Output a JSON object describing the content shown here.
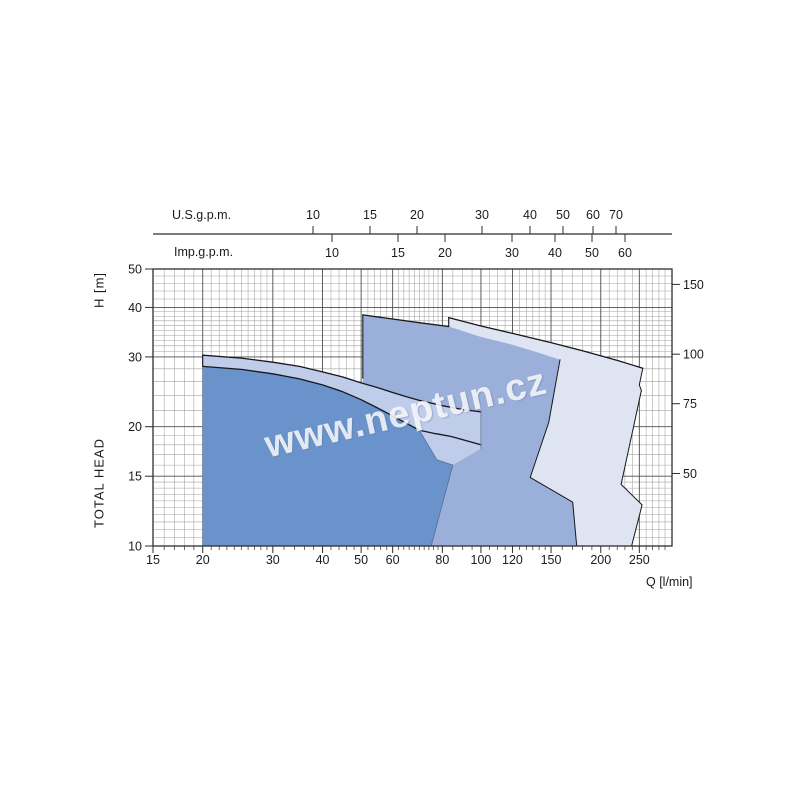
{
  "watermark": {
    "text": "www.neptun.cz",
    "color": "rgba(255,255,255,0.82)"
  },
  "titles": {
    "us_scale": "U.S.g.p.m.",
    "imp_scale": "Imp.g.p.m.",
    "y_left_unit": "H [m]",
    "y_left_name": "TOTAL HEAD",
    "x_bottom": "Q [l/min]"
  },
  "chart_data": {
    "type": "area",
    "title": "Pump family H-Q envelope chart",
    "x_axis": {
      "label": "Q [l/min]",
      "scale": "log",
      "min": 15,
      "max": 302,
      "major_ticks": [
        15,
        20,
        30,
        40,
        50,
        60,
        80,
        100,
        120,
        150,
        200,
        250
      ]
    },
    "y_axis": {
      "label": "H [m] TOTAL HEAD",
      "scale": "log",
      "min": 10,
      "max": 50,
      "major_ticks": [
        50,
        40,
        30,
        20,
        15,
        10
      ]
    },
    "y_axis_right": {
      "unit": "ft",
      "ticks": [
        150,
        100,
        75,
        50
      ],
      "m_per_ft": 0.3048
    },
    "us_gpm_scale": {
      "ticks": [
        [
          10,
          313
        ],
        [
          15,
          370
        ],
        [
          20,
          417
        ],
        [
          30,
          482
        ],
        [
          40,
          530
        ],
        [
          50,
          563
        ],
        [
          60,
          593
        ],
        [
          70,
          616
        ]
      ]
    },
    "imp_gpm_scale": {
      "ticks": [
        [
          10,
          332
        ],
        [
          15,
          398
        ],
        [
          20,
          445
        ],
        [
          30,
          512
        ],
        [
          40,
          555
        ],
        [
          50,
          592
        ],
        [
          60,
          625
        ]
      ]
    },
    "grid": {
      "v_major": [
        20,
        30,
        40,
        50,
        60,
        80,
        100,
        120,
        150,
        200,
        250
      ],
      "v_minor": [
        16,
        17,
        18,
        19,
        21,
        22,
        23,
        24,
        25,
        26,
        27,
        28,
        29,
        32,
        34,
        36,
        38,
        42,
        44,
        46,
        48,
        52,
        54,
        56,
        58,
        62,
        64,
        66,
        68,
        70,
        72,
        74,
        76,
        78,
        85,
        90,
        95,
        105,
        110,
        115,
        125,
        130,
        135,
        140,
        145,
        160,
        170,
        180,
        190,
        210,
        220,
        230,
        240,
        260,
        270,
        280,
        290
      ],
      "h_major": [
        15,
        20,
        30,
        40
      ],
      "h_minor": [
        10.5,
        11,
        11.5,
        12,
        12.5,
        13,
        13.5,
        14,
        14.5,
        16,
        17,
        18,
        19,
        22,
        24,
        26,
        28,
        31,
        32,
        33,
        34,
        35,
        36,
        37,
        38,
        39,
        42,
        44,
        46,
        48
      ]
    },
    "regions": [
      {
        "name": "envelope-large",
        "color_key": "pale",
        "points": [
          [
            83,
            37.7
          ],
          [
            100,
            35.9
          ],
          [
            120,
            34.4
          ],
          [
            150,
            32.6
          ],
          [
            180,
            31.1
          ],
          [
            220,
            29.4
          ],
          [
            255,
            28.1
          ],
          [
            250,
            25.5
          ],
          [
            253,
            24.7
          ],
          [
            225,
            14.3
          ],
          [
            254,
            12.7
          ],
          [
            239,
            10
          ],
          [
            83,
            10
          ]
        ]
      },
      {
        "name": "envelope-medium",
        "color_key": "medium",
        "points": [
          [
            50.5,
            38.3
          ],
          [
            60,
            37.4
          ],
          [
            70,
            36.6
          ],
          [
            83,
            35.8
          ],
          [
            100,
            33.7
          ],
          [
            120,
            32.2
          ],
          [
            140,
            30.7
          ],
          [
            158,
            29.5
          ],
          [
            148,
            20.5
          ],
          [
            133,
            14.9
          ],
          [
            170,
            12.9
          ],
          [
            174,
            10
          ],
          [
            50.5,
            10
          ]
        ]
      },
      {
        "name": "envelope-small",
        "color_key": "dark",
        "points": [
          [
            20,
            28.4
          ],
          [
            25,
            27.9
          ],
          [
            30,
            27.2
          ],
          [
            35,
            26.4
          ],
          [
            40,
            25.5
          ],
          [
            45,
            24.5
          ],
          [
            50,
            23.4
          ],
          [
            55,
            22.3
          ],
          [
            60,
            21.3
          ],
          [
            65,
            20.4
          ],
          [
            70,
            19.6
          ],
          [
            77.5,
            16.5
          ],
          [
            85,
            16
          ],
          [
            75,
            10
          ],
          [
            20,
            10
          ]
        ]
      },
      {
        "name": "top-band",
        "color_key": "band",
        "points": [
          [
            20,
            30.3
          ],
          [
            25,
            29.8
          ],
          [
            30,
            29.1
          ],
          [
            35,
            28.4
          ],
          [
            40,
            27.5
          ],
          [
            45,
            26.7
          ],
          [
            50,
            25.8
          ],
          [
            55,
            25.1
          ],
          [
            60,
            24.4
          ],
          [
            65,
            23.8
          ],
          [
            70,
            23.3
          ],
          [
            80,
            22.6
          ],
          [
            90,
            22.1
          ],
          [
            100,
            21.8
          ],
          [
            100,
            17.6
          ],
          [
            85,
            16
          ],
          [
            77.5,
            16.5
          ],
          [
            70,
            19.6
          ],
          [
            65,
            20.4
          ],
          [
            60,
            21.3
          ],
          [
            55,
            22.3
          ],
          [
            50,
            23.4
          ],
          [
            45,
            24.5
          ],
          [
            40,
            25.5
          ],
          [
            35,
            26.4
          ],
          [
            30,
            27.2
          ],
          [
            25,
            27.9
          ],
          [
            20,
            28.4
          ]
        ]
      }
    ],
    "curves": [
      {
        "name": "band-top-curve",
        "w": 1.3,
        "points": [
          [
            20,
            30.3
          ],
          [
            25,
            29.8
          ],
          [
            30,
            29.1
          ],
          [
            35,
            28.4
          ],
          [
            40,
            27.5
          ],
          [
            45,
            26.7
          ],
          [
            50,
            25.8
          ],
          [
            55,
            25.1
          ],
          [
            60,
            24.4
          ],
          [
            65,
            23.8
          ],
          [
            70,
            23.3
          ],
          [
            80,
            22.6
          ],
          [
            90,
            22.1
          ],
          [
            100,
            21.8
          ]
        ]
      },
      {
        "name": "band-bottom-curve",
        "w": 1.3,
        "points": [
          [
            20,
            28.4
          ],
          [
            25,
            27.9
          ],
          [
            30,
            27.2
          ],
          [
            35,
            26.4
          ],
          [
            40,
            25.5
          ],
          [
            45,
            24.5
          ],
          [
            50,
            23.4
          ],
          [
            55,
            22.3
          ],
          [
            60,
            21.3
          ],
          [
            65,
            20.4
          ],
          [
            70,
            19.6
          ],
          [
            77,
            19.2
          ],
          [
            84,
            18.9
          ],
          [
            100,
            18
          ]
        ]
      },
      {
        "name": "band-left-edge",
        "w": 1.1,
        "points": [
          [
            20,
            30.3
          ],
          [
            20,
            28.4
          ]
        ]
      },
      {
        "name": "band-right-edge",
        "w": 0.8,
        "color": "#6a7a9a",
        "points": [
          [
            100,
            21.8
          ],
          [
            100,
            17.6
          ]
        ]
      },
      {
        "name": "medium-top-curve",
        "w": 1.3,
        "points": [
          [
            50.5,
            38.3
          ],
          [
            60,
            37.4
          ],
          [
            70,
            36.6
          ],
          [
            83,
            35.8
          ]
        ]
      },
      {
        "name": "medium-left-edge",
        "w": 1.1,
        "points": [
          [
            50.5,
            38.3
          ],
          [
            50.5,
            26.5
          ]
        ]
      },
      {
        "name": "medium-right-edge",
        "w": 1.0,
        "points": [
          [
            158,
            29.5
          ],
          [
            148,
            20.5
          ],
          [
            133,
            14.9
          ],
          [
            170,
            12.9
          ],
          [
            174,
            10
          ]
        ]
      },
      {
        "name": "pale-top-curve",
        "w": 1.3,
        "points": [
          [
            83,
            37.7
          ],
          [
            100,
            35.9
          ],
          [
            120,
            34.4
          ],
          [
            150,
            32.6
          ],
          [
            180,
            31.1
          ],
          [
            220,
            29.4
          ],
          [
            255,
            28.1
          ]
        ]
      },
      {
        "name": "pale-left-edge",
        "w": 1.1,
        "points": [
          [
            83,
            37.7
          ],
          [
            83,
            35.8
          ]
        ]
      },
      {
        "name": "pale-right-edge",
        "w": 1.0,
        "points": [
          [
            255,
            28.1
          ],
          [
            250,
            25.5
          ],
          [
            253,
            24.7
          ],
          [
            225,
            14.3
          ],
          [
            254,
            12.7
          ],
          [
            239,
            10
          ]
        ]
      },
      {
        "name": "small-step-edge",
        "w": 0.8,
        "color": "#5a6d96",
        "points": [
          [
            70,
            19.6
          ],
          [
            77.5,
            16.5
          ],
          [
            85,
            16
          ],
          [
            75,
            10
          ]
        ]
      }
    ],
    "colors": {
      "pale": "#dee4f2",
      "medium": "#9ab0da",
      "dark": "#6b93cb",
      "band": "#bfccea",
      "stroke": "#17171c",
      "grid_minor": "#a3a3a3",
      "grid_major": "#4f4f4f",
      "frame": "#2e2e2e",
      "text": "#1c1c1c"
    },
    "plot": {
      "x0": 153,
      "x1": 672,
      "y0": 269,
      "y1": 546,
      "q0": 15,
      "q1": 302,
      "h_top": 50,
      "h_bottom": 10,
      "scale_line_y": 234
    }
  }
}
